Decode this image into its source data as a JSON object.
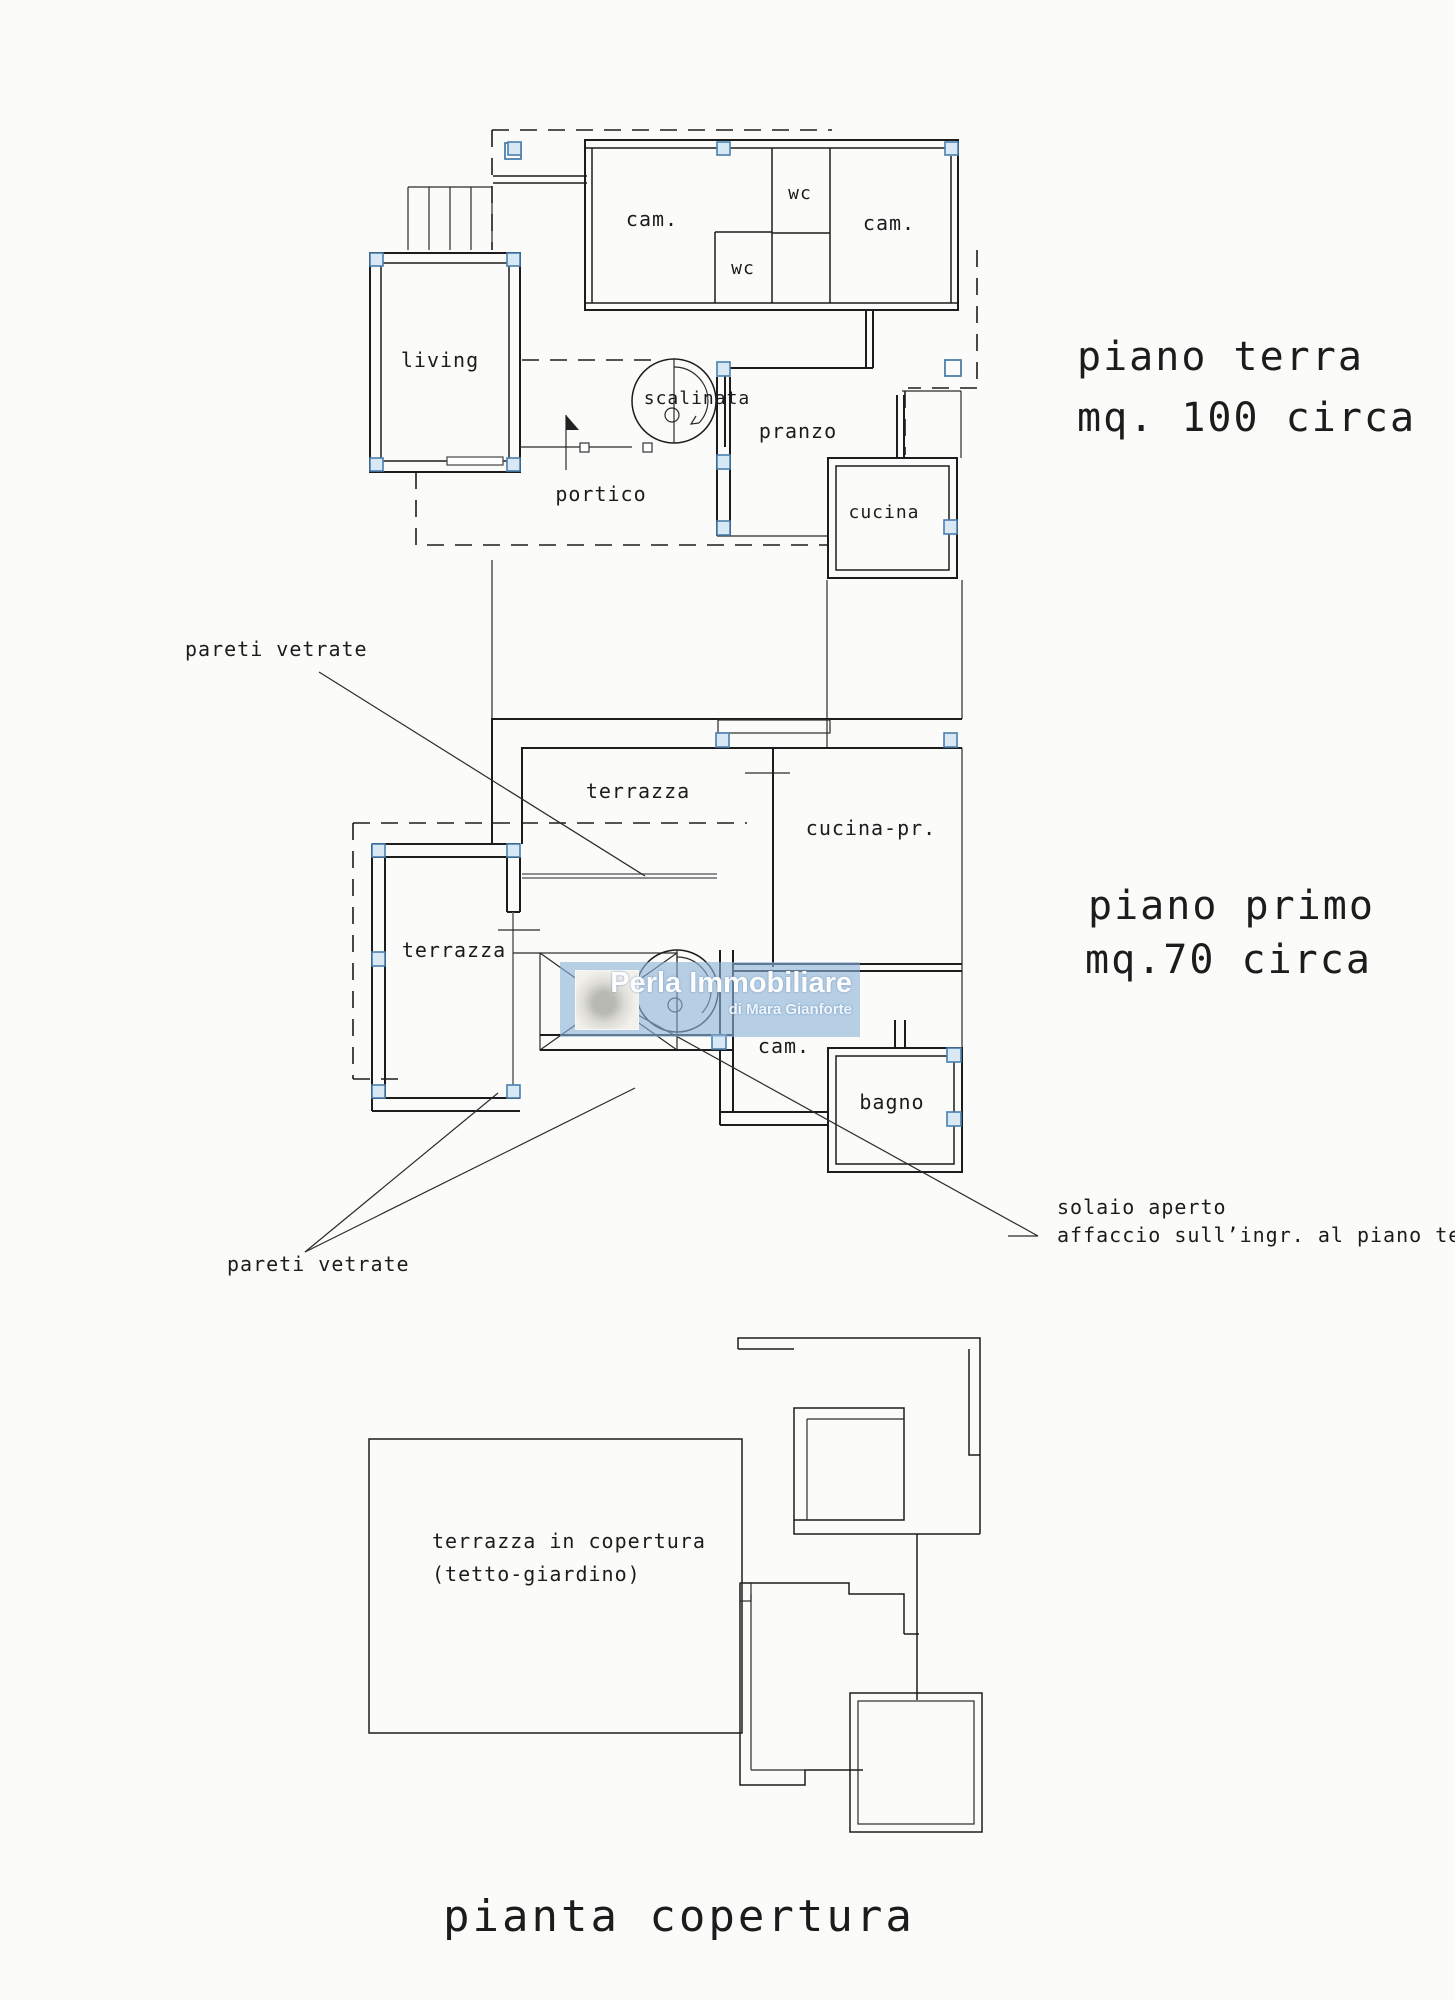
{
  "ground_floor": {
    "title": "piano terra",
    "area": "mq. 100 circa",
    "rooms": {
      "cam_left": "cam.",
      "wc_top": "wc",
      "wc_bottom": "wc",
      "cam_right": "cam.",
      "living": "living",
      "scalinata": "scalinata",
      "pranzo": "pranzo",
      "portico": "portico",
      "cucina": "cucina"
    }
  },
  "first_floor": {
    "title": "piano primo",
    "area": "mq.70 circa",
    "rooms": {
      "terrazza_top": "terrazza",
      "cucina_pr": "cucina-pr.",
      "terrazza_left": "terrazza",
      "cam": "cam.",
      "bagno": "bagno",
      "scalinata": ""
    },
    "annotations": {
      "pareti_vetrate_top": "pareti vetrate",
      "pareti_vetrate_bottom": "pareti vetrate",
      "solaio_line1": "solaio aperto",
      "solaio_line2": "affaccio sull’ingr. al piano terra"
    }
  },
  "roof_plan": {
    "label_line1": "terrazza in copertura",
    "label_line2": "(tetto-giardino)",
    "title": "pianta copertura"
  },
  "watermark": {
    "agency_name": "Perla Immobiliare",
    "agency_subtitle": "di Mara Gianforte",
    "bg_color": "#8db3d9"
  },
  "colors": {
    "paper": "#fbfbf9",
    "ink": "#1c1c1c",
    "pillar_stroke": "#4a7fae",
    "pillar_fill": "#d9e8f5",
    "watermark_bg": "#8db3d9"
  }
}
